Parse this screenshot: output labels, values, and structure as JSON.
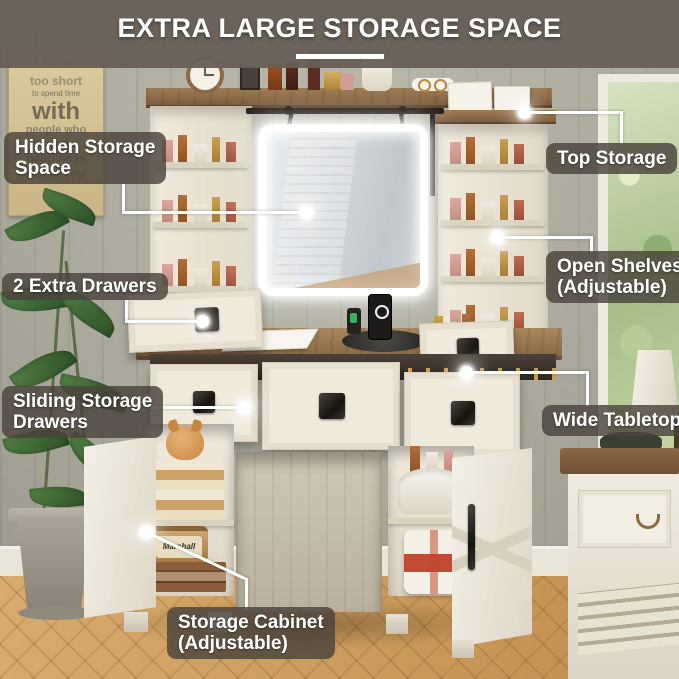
{
  "title": {
    "text": "EXTRA LARGE STORAGE SPACE"
  },
  "callouts": [
    {
      "id": "hidden-storage",
      "label": "Hidden Storage Space",
      "lines": [
        "Hidden Storage",
        "Space"
      ]
    },
    {
      "id": "top-storage",
      "label": "Top Storage",
      "lines": [
        "Top Storage"
      ]
    },
    {
      "id": "extra-drawers",
      "label": "2 Extra Drawers",
      "lines": [
        "2 Extra Drawers"
      ]
    },
    {
      "id": "open-shelves",
      "label": "Open Shelves (Adjustable)",
      "lines": [
        "Open Shelves",
        "(Adjustable)"
      ]
    },
    {
      "id": "sliding-drawers",
      "label": "Sliding Storage Drawers",
      "lines": [
        "Sliding Storage",
        "Drawers"
      ]
    },
    {
      "id": "wide-tabletop",
      "label": "Wide Tabletop",
      "lines": [
        "Wide Tabletop"
      ]
    },
    {
      "id": "storage-cabinet",
      "label": "Storage Cabinet (Adjustable)",
      "lines": [
        "Storage Cabinet",
        "(Adjustable)"
      ]
    }
  ],
  "wall_sign": {
    "lines": [
      "Life is",
      "too short",
      "to spend time",
      "with",
      "people who",
      "suck the",
      "happiness",
      "out of you"
    ]
  },
  "speaker_brand": "Marshall",
  "colors": {
    "title_band": "#685f56",
    "label_bg": "#4a433c",
    "label_text": "#ffffff",
    "led_white": "#ffffff",
    "wall": "#b2b1a3",
    "cream_furniture": "#efe9dc",
    "wood_top": "#8a6843",
    "floor_wood": "#cfa15f",
    "bag_red": "#c24b35"
  }
}
